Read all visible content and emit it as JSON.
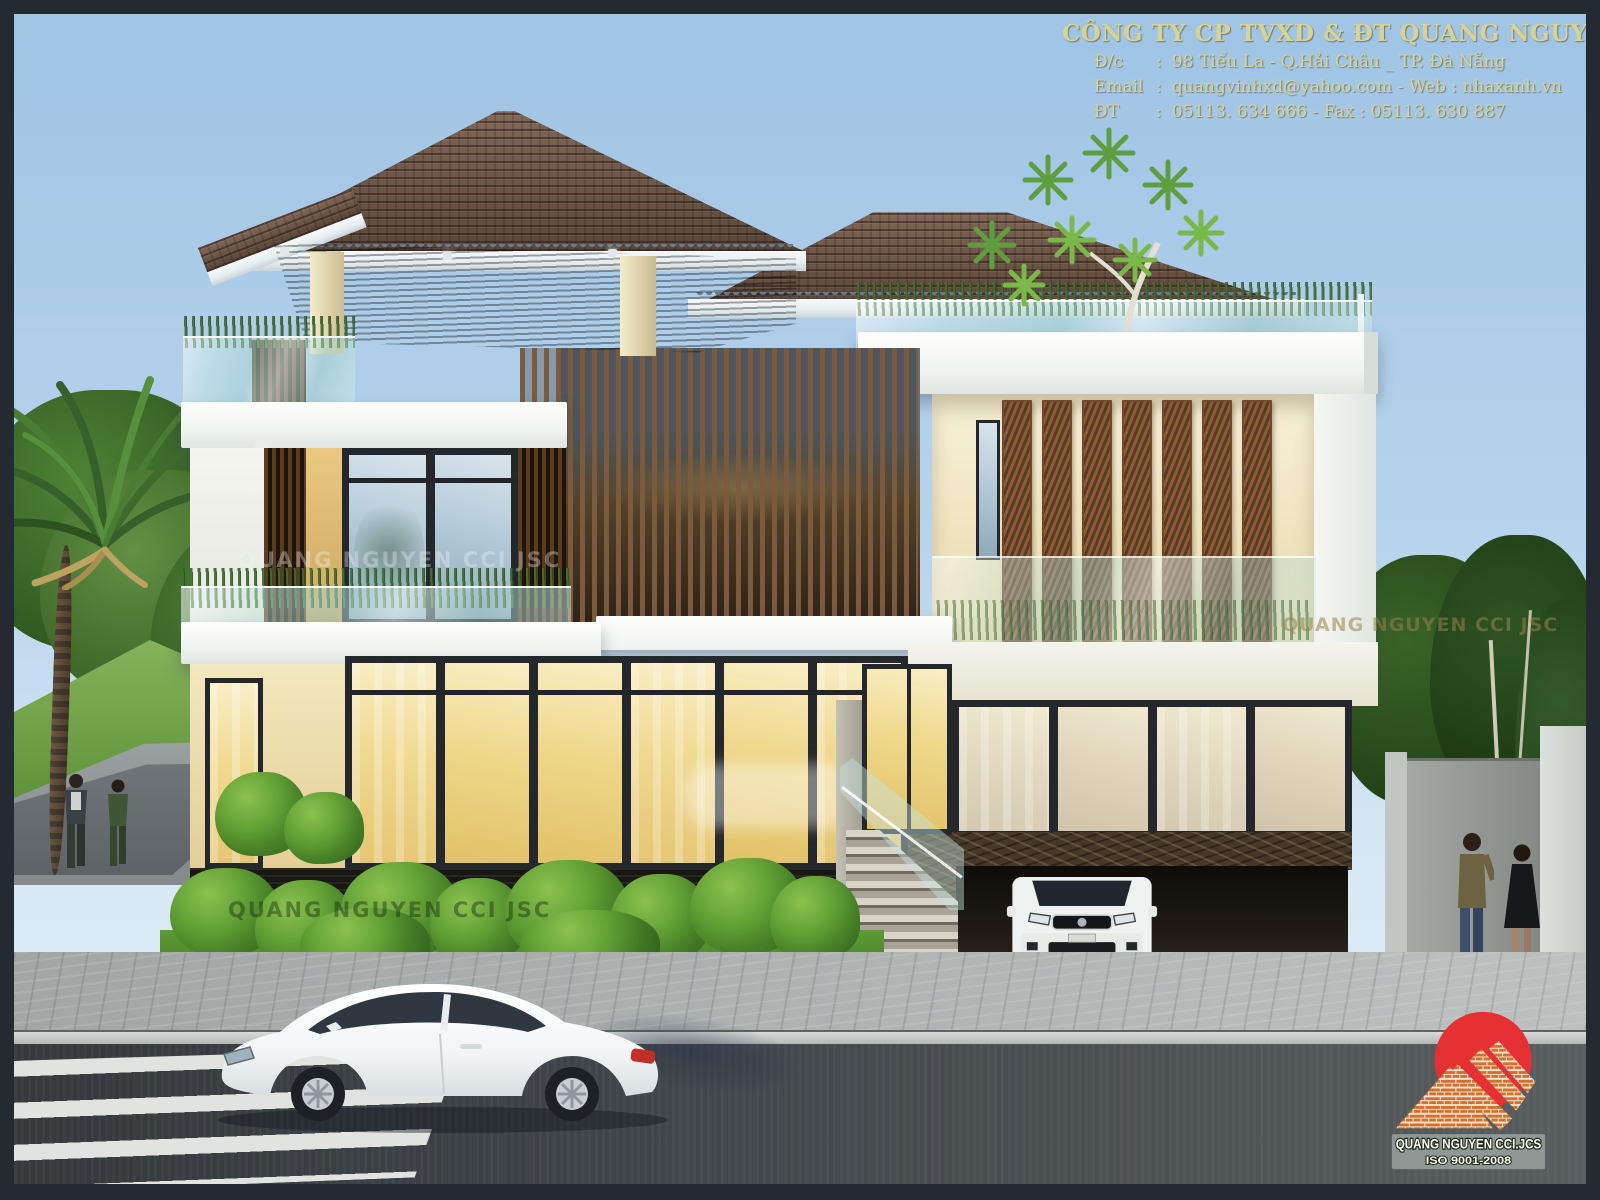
{
  "page": {
    "width": 1600,
    "height": 1200
  },
  "header": {
    "company": "CÔNG TY CP TVXD & ĐT QUANG NGUYỄN",
    "colon": ":",
    "rows": [
      {
        "label": "Đ/c",
        "value": "98 Tiểu La - Q.Hải Châu _ TP. Đà Nẵng"
      },
      {
        "label": "Email",
        "value": "quangvinhxd@yahoo.com - Web : nhaxanh.vn"
      },
      {
        "label": "ĐT",
        "value": "05113. 634 666 - Fax : 05113. 630 887"
      }
    ]
  },
  "watermark": {
    "text": "QUANG NGUYEN CCI JSC"
  },
  "logo": {
    "company": "QUANG NGUYEN CCI.JCS",
    "iso": "ISO 9001-2008"
  },
  "colors": {
    "sky_top": "#9ec3e4",
    "sky_horizon": "#e4eff6",
    "header_text": "#d9d295",
    "logo_red": "#e53134",
    "brick_orange": "#d4702c",
    "roof_tile": "#6f5948",
    "wood_slat": "#7d5a3b",
    "window_warm": "#efd88b",
    "glass_teal": "#aad4d0",
    "asphalt": "#43474a",
    "lawn_green": "#69a13f",
    "border_frame": "#242a32"
  }
}
